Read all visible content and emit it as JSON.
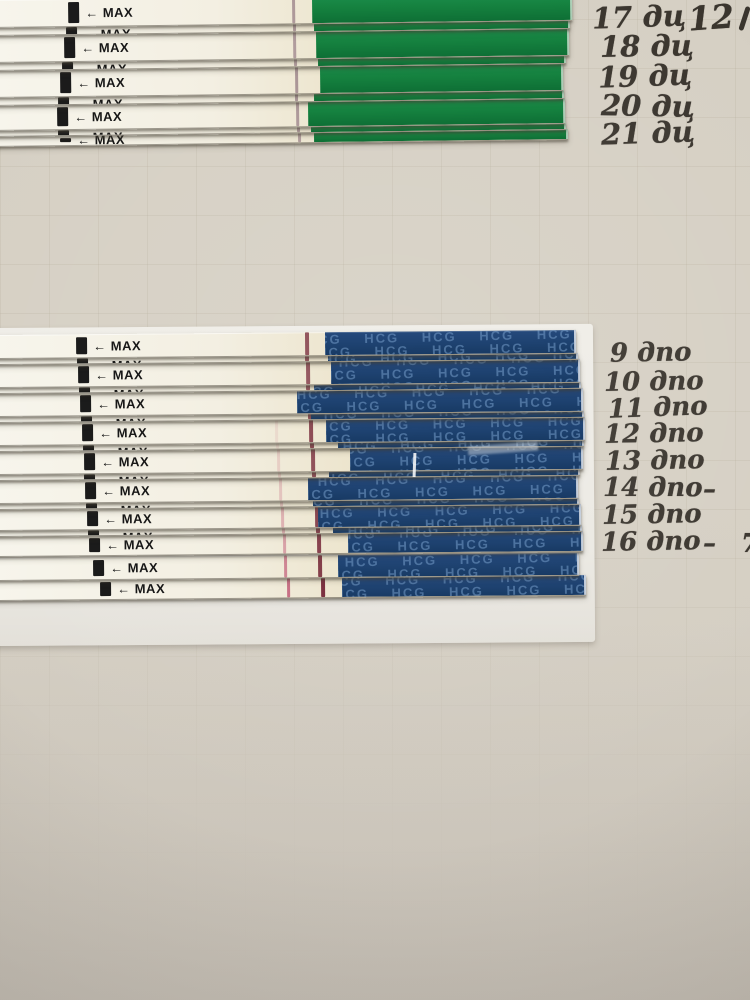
{
  "print": {
    "arrow": "←",
    "max_label": "MAX",
    "hcg_tile": "HCG HCG HCG HCG HCG HCG HCG HCG HCG HCG HCG HCG HCG HCG HCG HCG HCG HCG HCG HCG HCG HCG HCG HCG"
  },
  "colors": {
    "paper": "#d6d0c4",
    "green_handle": "#15813f",
    "blue_handle": "#1e4270",
    "hcg_text": "#7da3cf",
    "control_line": "#7c3140",
    "test_line": "#c2607a",
    "top_strip_line": "#6d4a60",
    "ink": "#3a352e"
  },
  "top_section": {
    "labels": [
      "17 дц",
      "18 дц",
      "19 дц",
      "20 дц",
      "21 дц"
    ],
    "corner_label": "12",
    "strips": [
      {
        "control_line": 0.5,
        "test_line": 0
      },
      {
        "control_line": 0.48,
        "test_line": 0
      },
      {
        "control_line": 0.52,
        "test_line": 0
      },
      {
        "control_line": 0.5,
        "test_line": 0
      },
      {
        "control_line": 0.45,
        "test_line": 0
      }
    ]
  },
  "bottom_section": {
    "labels": [
      {
        "text": "9 дпо",
        "suffix": ""
      },
      {
        "text": "10 дпо",
        "suffix": ""
      },
      {
        "text": "11 дпо",
        "suffix": ""
      },
      {
        "text": "12 дпо",
        "suffix": ""
      },
      {
        "text": "13 дпо",
        "suffix": ""
      },
      {
        "text": "14 дпо",
        "suffix": "–"
      },
      {
        "text": "15 дпо",
        "suffix": ""
      },
      {
        "text": "16 дпо",
        "suffix": "– 7"
      }
    ],
    "strips": [
      {
        "control_line": 0.8,
        "test_line": 0
      },
      {
        "control_line": 0.78,
        "test_line": 0
      },
      {
        "control_line": 0.82,
        "test_line": 0
      },
      {
        "control_line": 0.85,
        "test_line": 0.12
      },
      {
        "control_line": 0.82,
        "test_line": 0.2
      },
      {
        "control_line": 0.85,
        "test_line": 0.28
      },
      {
        "control_line": 0.88,
        "test_line": 0.4
      },
      {
        "control_line": 0.9,
        "test_line": 0.52
      },
      {
        "control_line": 0.93,
        "test_line": 0.72
      },
      {
        "control_line": 1.0,
        "test_line": 0.88
      }
    ]
  }
}
